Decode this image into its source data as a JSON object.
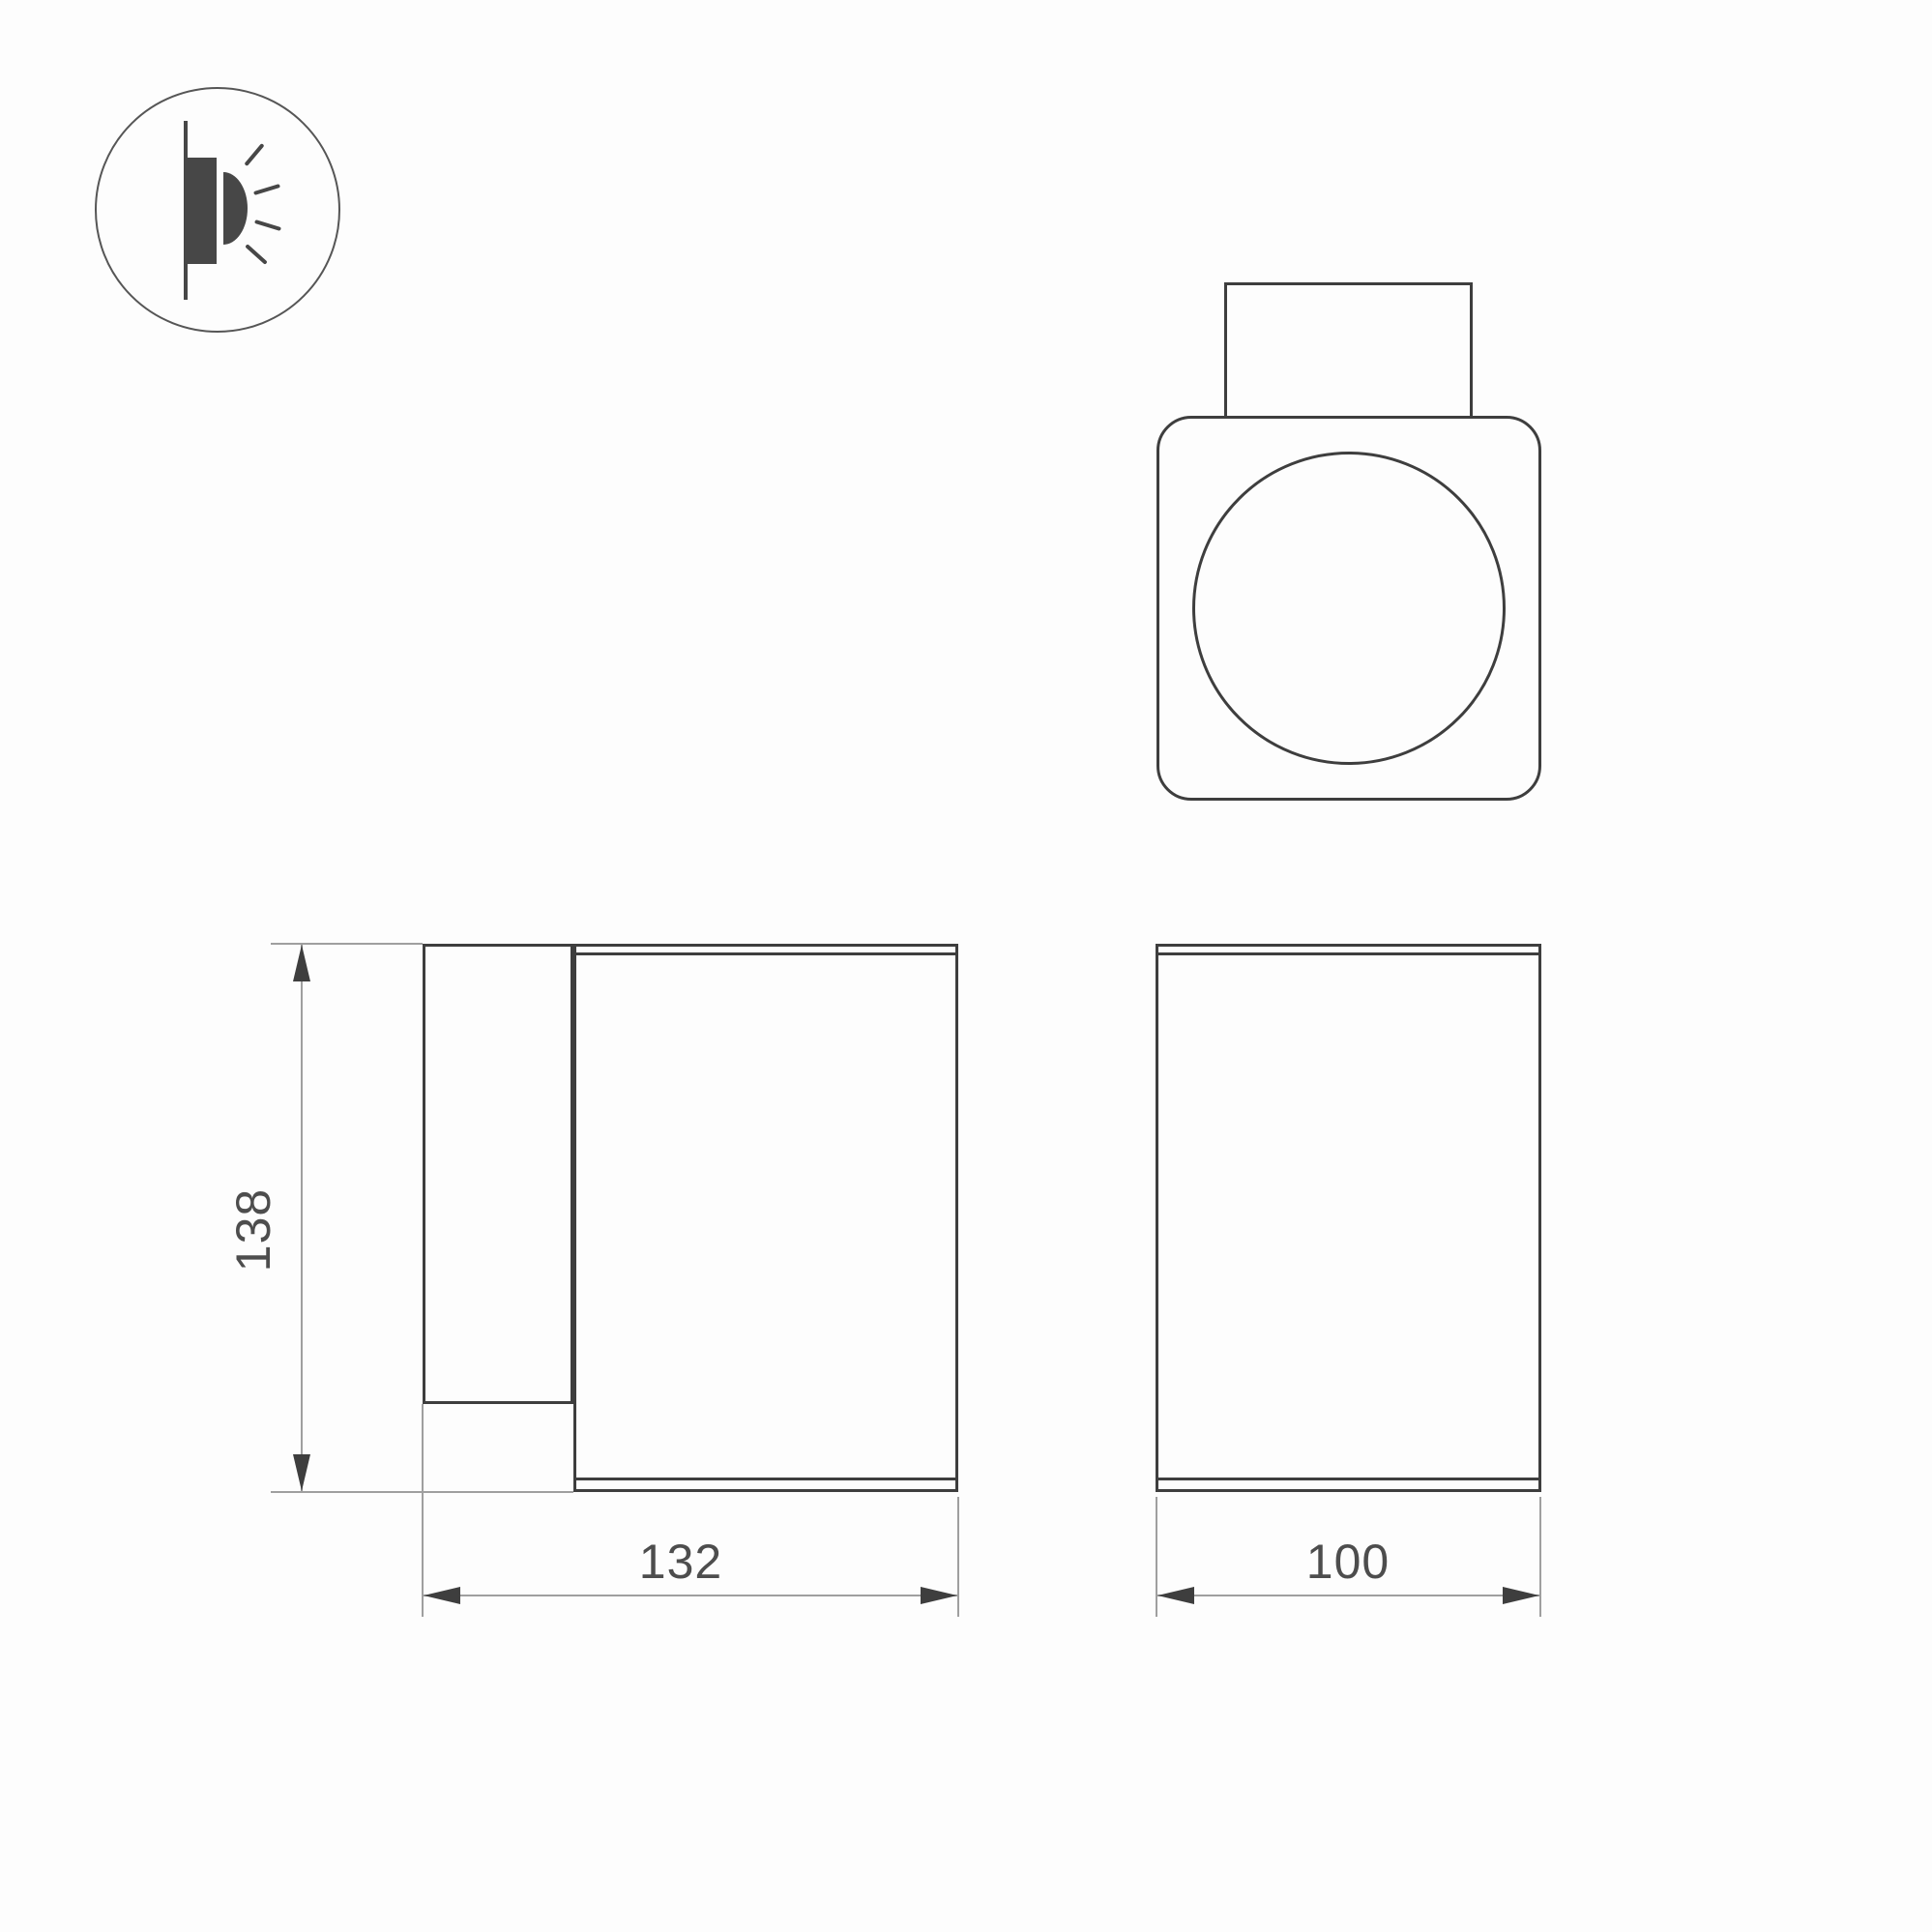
{
  "drawing": {
    "icon": "surface-mounted-wall-light-icon",
    "dimensions": {
      "height": "138",
      "side_width": "132",
      "front_width": "100"
    },
    "colors": {
      "outline": "#3e3e3e",
      "icon_fill": "#474747",
      "dimension_line": "#9f9f9f",
      "text": "#4d4d4d",
      "background": "#fdfdfd"
    }
  }
}
